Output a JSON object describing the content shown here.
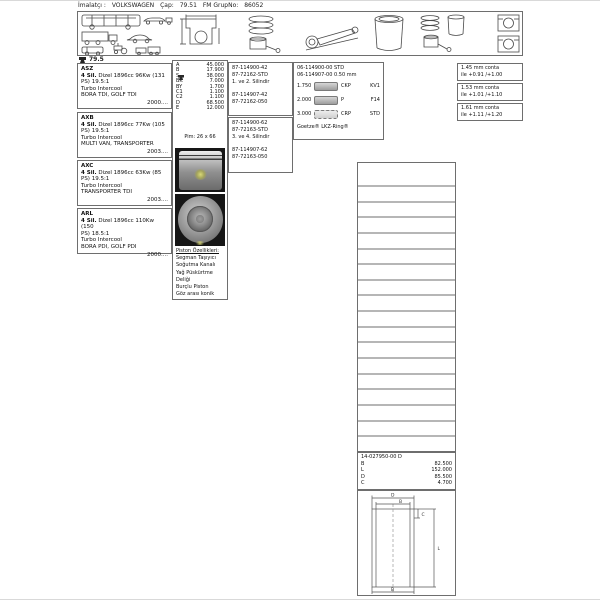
{
  "header": {
    "manufacturer_label": "İmalatçı :",
    "manufacturer": "VOLKSWAGEN",
    "bore_label": "Çap:",
    "bore": "79.51",
    "group_label": "FM GrupNo:",
    "group": "86052"
  },
  "bore_tag": "79.5",
  "engines": [
    {
      "code": "ASZ",
      "cyl": "4 Sil.",
      "desc1": "Dizel 1896cc 96Kw (131",
      "desc2": "PS) 19.5:1",
      "aspiration": "Turbo Intercool",
      "models": "BORA TDI, GOLF TDI",
      "year": "2000...."
    },
    {
      "code": "AXB",
      "cyl": "4 Sil.",
      "desc1": "Dizel 1896cc 77Kw (105",
      "desc2": "PS) 19.5:1",
      "aspiration": "Turbo Intercool",
      "models": "MULTI VAN, TRANSPORTER",
      "year": "2003...."
    },
    {
      "code": "AXC",
      "cyl": "4 Sil.",
      "desc1": "Dizel 1896cc 63Kw (85",
      "desc2": "PS) 19.5:1",
      "aspiration": "Turbo Intercool",
      "models": "TRANSPORTER TDI",
      "year": "2003...."
    },
    {
      "code": "ARL",
      "cyl": "4 Sil.",
      "desc1": "Dizel 1896cc 110Kw (150",
      "desc2": "PS) 18.5:1",
      "aspiration": "Turbo Intercool",
      "models": "BORA PDI, GOLF PDI",
      "year": "2000...."
    }
  ],
  "dimensions": {
    "rows": [
      {
        "label": "A",
        "value": "45.000"
      },
      {
        "label": "B",
        "value": "17.900"
      },
      {
        "label": "S",
        "value": "38.000"
      },
      {
        "label": "BK",
        "value": "7.000"
      },
      {
        "label": "BY",
        "value": "1.700"
      },
      {
        "label": "C1",
        "value": "1.100"
      },
      {
        "label": "C2",
        "value": "1.100"
      },
      {
        "label": "D",
        "value": "68.500"
      },
      {
        "label": "E",
        "value": "12.000"
      }
    ],
    "pin": "Pim: 26 x 66"
  },
  "piston_features": {
    "title": "Piston Özellikleri:",
    "items": [
      "Segman Taşıyıcı",
      "Soğutma Kanalı",
      "Yağ Püskürtme",
      "Deliği",
      "Burçlu Piston",
      "Göz arası konik"
    ]
  },
  "piston_sets": [
    {
      "pn_std": "87-114900-42",
      "rings_std": "87-72162-STD",
      "cylinders": "1. ve 2. Silindir",
      "pn_050": "87-114907-42",
      "rings_050": "87-72162-050"
    },
    {
      "pn_std": "87-114900-62",
      "rings_std": "87-72163-STD",
      "cylinders": "3. ve 4. Silindir",
      "pn_050": "87-114907-62",
      "rings_050": "87-72163-050"
    }
  ],
  "ring_set": {
    "pn_std": "06-114900-00 STD",
    "pn_050": "06-114907-00 0.50 mm",
    "rows": [
      {
        "size": "1.750",
        "code": "CKP",
        "type": "KV1"
      },
      {
        "size": "2.000",
        "code": "P",
        "type": "F14"
      },
      {
        "size": "3.000",
        "code": "CRP",
        "type": "STD"
      }
    ],
    "footer": "Goetze® LKZ-Ring®"
  },
  "gaskets": [
    {
      "size": "1.45 mm conta",
      "range": "ile +0.91 /+1.00"
    },
    {
      "size": "1.53 mm conta",
      "range": "ile +1.01 /+1.10"
    },
    {
      "size": "1.61 mm conta",
      "range": "ile +1.11 /+1.20"
    }
  ],
  "right_table": {
    "empty_rows": 17
  },
  "liner": {
    "part_no": "14-027950-00 D",
    "rows": [
      {
        "label": "B",
        "value": "82.500"
      },
      {
        "label": "L",
        "value": "152.000"
      },
      {
        "label": "D",
        "value": "85.500"
      },
      {
        "label": "C",
        "value": "4.700"
      }
    ],
    "drawing_labels": {
      "top": "D",
      "top_inner": "B",
      "flange": "C",
      "length": "L",
      "bottom": "B"
    }
  }
}
